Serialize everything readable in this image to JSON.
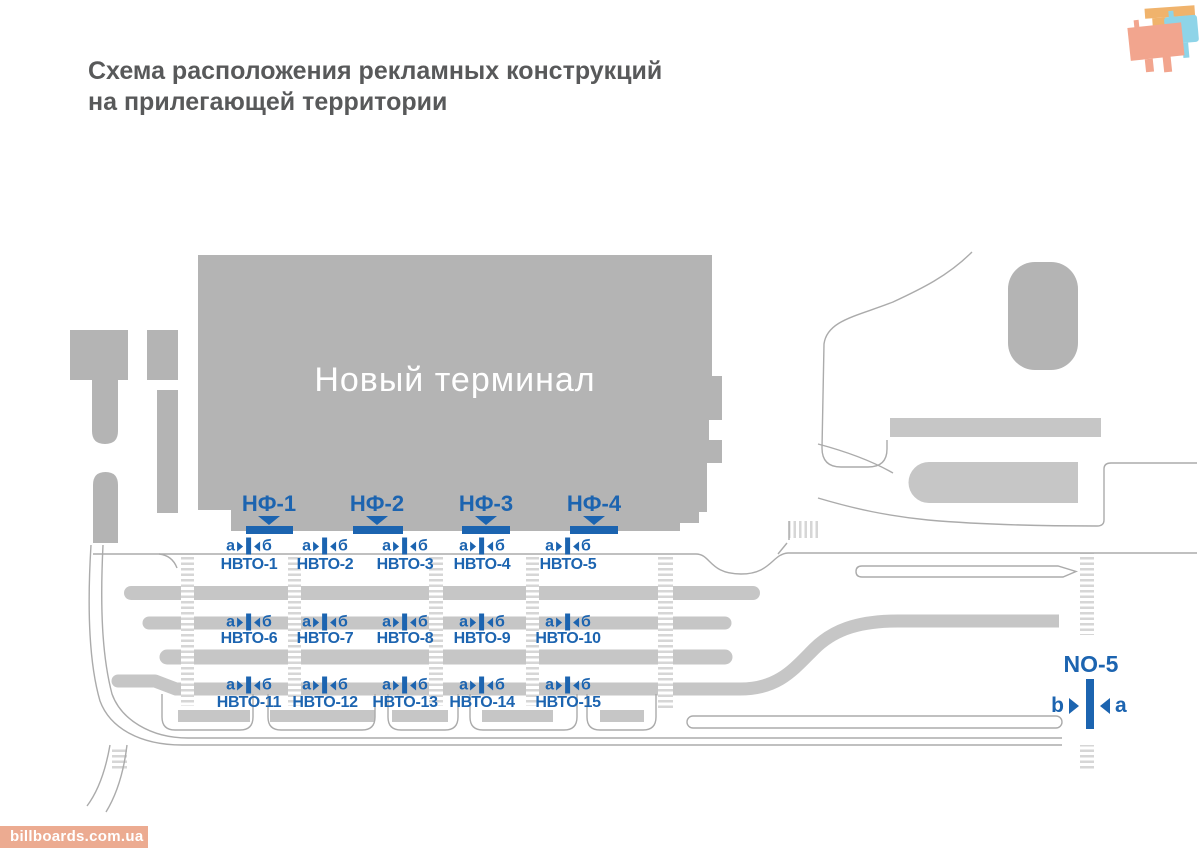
{
  "title": {
    "line1": "Схема расположения рекламных конструкций",
    "line2": "на прилегающей территории"
  },
  "terminal": {
    "label": "Новый терминал"
  },
  "watermark": "billboards.com.ua",
  "colors": {
    "accent_blue": "#1c64b0",
    "building_gray": "#b4b4b4",
    "island_gray": "#c6c6c6",
    "road_line_gray": "#ababab",
    "hatch_gray": "#d6d6d6",
    "title_gray": "#58595a",
    "watermark_bg": "#ecab91",
    "logo_orange": "#f0b36c",
    "logo_blue": "#8ed4e8",
    "logo_salmon": "#f2a58e"
  },
  "map": {
    "nf_signs": [
      {
        "label": "НФ-1",
        "cx": 269,
        "bar_x": 246,
        "bar_w": 47
      },
      {
        "label": "НФ-2",
        "cx": 377,
        "bar_x": 353,
        "bar_w": 50
      },
      {
        "label": "НФ-3",
        "cx": 486,
        "bar_x": 462,
        "bar_w": 48
      },
      {
        "label": "НФ-4",
        "cx": 594,
        "bar_x": 570,
        "bar_w": 48
      }
    ],
    "marker_letters": {
      "left": "а",
      "right": "б"
    },
    "marker_cols": [
      249,
      325,
      405,
      482,
      568
    ],
    "marker_rows_y": [
      546,
      622,
      685
    ],
    "nvto_rows": [
      {
        "y": 565,
        "labels": [
          "НВТО-1",
          "НВТО-2",
          "НВТО-3",
          "НВТО-4",
          "НВТО-5"
        ]
      },
      {
        "y": 639,
        "labels": [
          "НВТО-6",
          "НВТО-7",
          "НВТО-8",
          "НВТО-9",
          "НВТО-10"
        ]
      },
      {
        "y": 703,
        "labels": [
          "НВТО-11",
          "НВТО-12",
          "НВТО-13",
          "НВТО-14",
          "НВТО-15"
        ]
      }
    ],
    "no5": {
      "label": "NO-5",
      "left_letter": "b",
      "right_letter": "a"
    }
  }
}
